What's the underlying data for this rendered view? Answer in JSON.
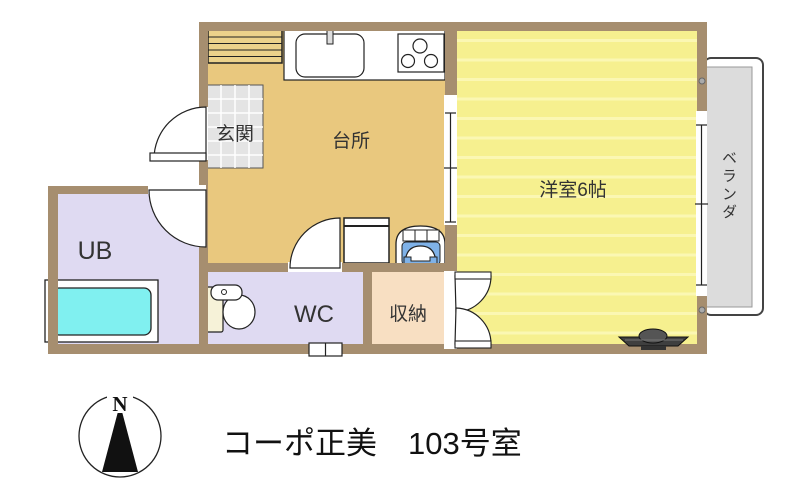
{
  "title": "コーポ正美　103号室",
  "compass": {
    "north": "N"
  },
  "rooms": {
    "entrance": {
      "label": "玄関"
    },
    "kitchen": {
      "label": "台所"
    },
    "western_room": {
      "label": "洋室6帖"
    },
    "veranda": {
      "label": "ベランダ"
    },
    "unit_bath": {
      "label": "UB"
    },
    "toilet": {
      "label": "WC"
    },
    "storage": {
      "label": "収納"
    }
  },
  "colors": {
    "wall": "#a68e6f",
    "kitchen_floor": "#e9c87e",
    "western_floor": "#f6f08f",
    "western_stripe": "#fbf7b3",
    "bath_floor": "#dfdaf2",
    "storage_floor": "#f8dfc2",
    "entrance_tile": "#e4e4e4",
    "veranda_floor": "#dcdcdc",
    "bathtub": "#80f0f0",
    "basin_bowl": "#7fb2e8",
    "cabinet": "#ecd28b",
    "toilet_tank": "#f6f2d8",
    "light_fixture": "#3f3f3f"
  }
}
